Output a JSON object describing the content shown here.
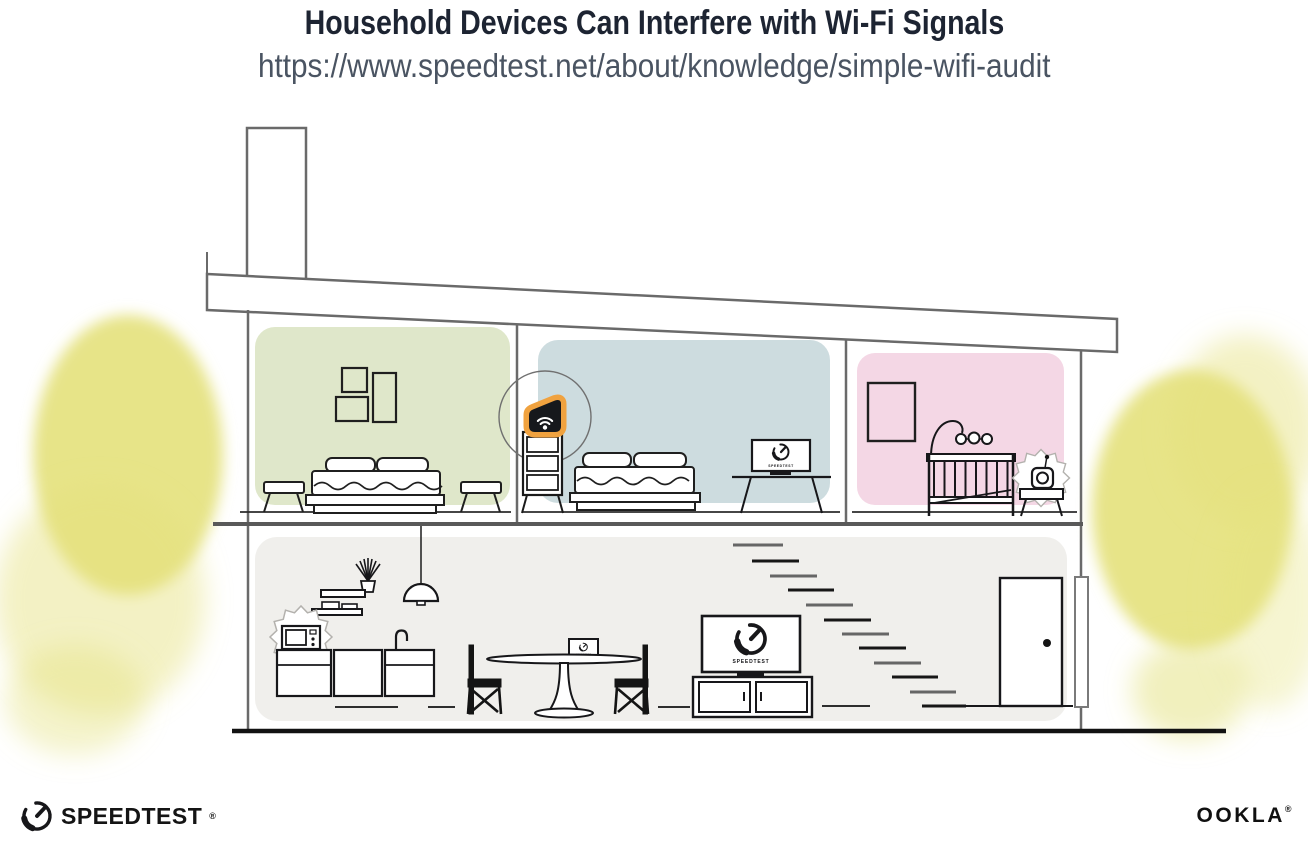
{
  "header": {
    "title": "Household Devices Can Interfere with Wi-Fi Signals",
    "url": "https://www.speedtest.net/about/knowledge/simple-wifi-audit"
  },
  "illustration": {
    "tv_screen_label": "SPEEDTEST",
    "monitor_screen_label": "SPEEDTEST",
    "laptop_screen_label": "SPEEDTEST",
    "colors": {
      "room_green": "#dfe7ca",
      "room_blue": "#cddcdf",
      "room_pink": "#f4d7e5",
      "floor_lower": "#f0efec",
      "router_highlight": "#f0a23f",
      "tree_yellow": "#e4e17c"
    }
  },
  "footer": {
    "speedtest_label": "SPEEDTEST",
    "speedtest_reg": "®",
    "ookla_label": "OOKLA",
    "ookla_reg": "®"
  }
}
